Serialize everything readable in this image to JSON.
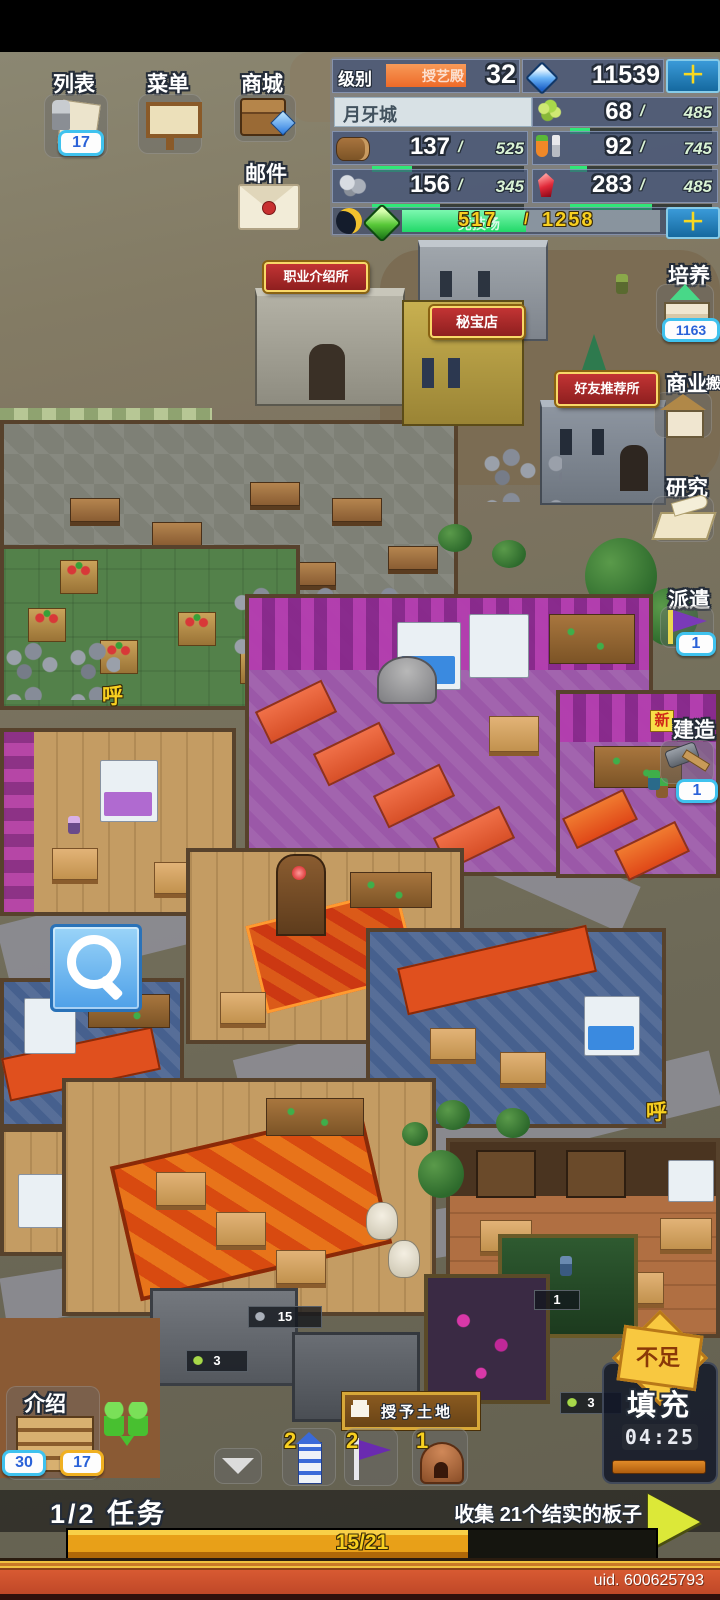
{
  "top_left_buttons": {
    "list": {
      "label": "列表",
      "badge": "17"
    },
    "menu": {
      "label": "菜单"
    },
    "mall": {
      "label": "商城"
    },
    "mail": {
      "label": "邮件"
    }
  },
  "hud": {
    "level_label": "级别",
    "level_value": "32",
    "building_behind": "授艺殿",
    "diamonds": "11539",
    "plus": "＋",
    "sep": "/",
    "city_name": "月牙城",
    "resources": {
      "crop": {
        "value": "68",
        "max": "485",
        "pct": 14
      },
      "wood": {
        "value": "137",
        "max": "525",
        "pct": 26
      },
      "food": {
        "value": "92",
        "max": "745",
        "pct": 12
      },
      "stone": {
        "value": "156",
        "max": "345",
        "pct": 45
      },
      "crystal": {
        "value": "283",
        "max": "485",
        "pct": 58
      }
    },
    "xp": {
      "value": "517",
      "max": "1258",
      "pct": 48,
      "behind": "竞技场"
    }
  },
  "right_buttons": {
    "train": {
      "label": "培养",
      "badge": "1163"
    },
    "business": {
      "label": "商业",
      "partial": "搬"
    },
    "research": {
      "label": "研究"
    },
    "dispatch": {
      "label": "派遣",
      "badge": "1"
    },
    "build": {
      "label": "建造",
      "badge": "1",
      "new_tag": "新"
    }
  },
  "map": {
    "plaques": [
      "职业介绍所",
      "秘宝店",
      "好友推荐所"
    ],
    "bubbles": [
      "呼",
      "呼"
    ],
    "badges": {
      "stone": "15",
      "crop_a": "3",
      "crop_b": "3",
      "platform": "1"
    }
  },
  "bottom": {
    "intro": {
      "label": "介绍",
      "badge_a": "30",
      "badge_b": "17"
    },
    "land_banner": "授予土地",
    "items": {
      "tower": "2",
      "flag": "2",
      "kiln": "1"
    },
    "fill": {
      "warning": "不足",
      "action": "填充",
      "timer": "04:25"
    }
  },
  "task": {
    "counter": "1/2 任务",
    "description": "收集 21个结实的板子",
    "progress_text": "15/21",
    "progress_pct": 68
  },
  "footer": {
    "uid": "uid. 600625793"
  },
  "colors": {
    "accent_green": "#2ce87a",
    "bar_orange": "#e8a018",
    "hud_blue": "#3a4e7c",
    "badge_cyan": "#3fc2ee",
    "plaque_red": "#a82828"
  }
}
